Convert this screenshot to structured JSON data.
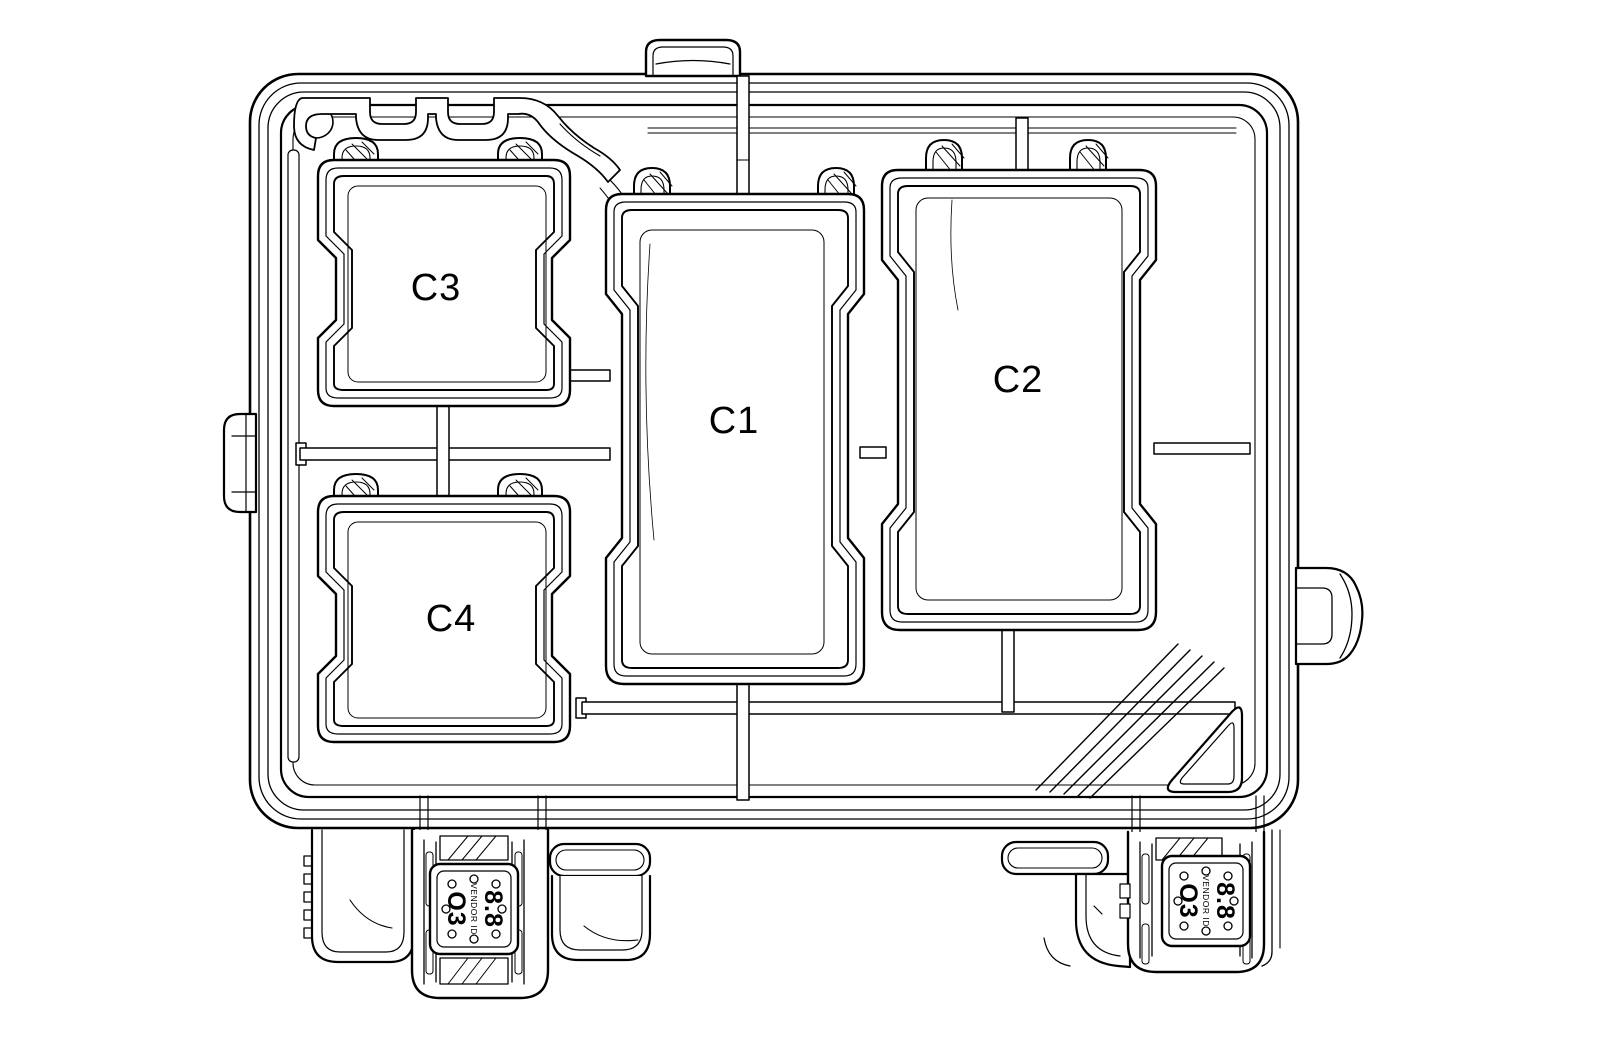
{
  "figure": {
    "background_color": "#ffffff",
    "line_color": "#000000",
    "cavity_labels": {
      "c1": "C1",
      "c2": "C2",
      "c3": "C3",
      "c4": "C4"
    },
    "connector_face_markings": {
      "cavity_code": "O3",
      "vendor_text": "VENDOR ID",
      "size_code": "8.8"
    }
  }
}
